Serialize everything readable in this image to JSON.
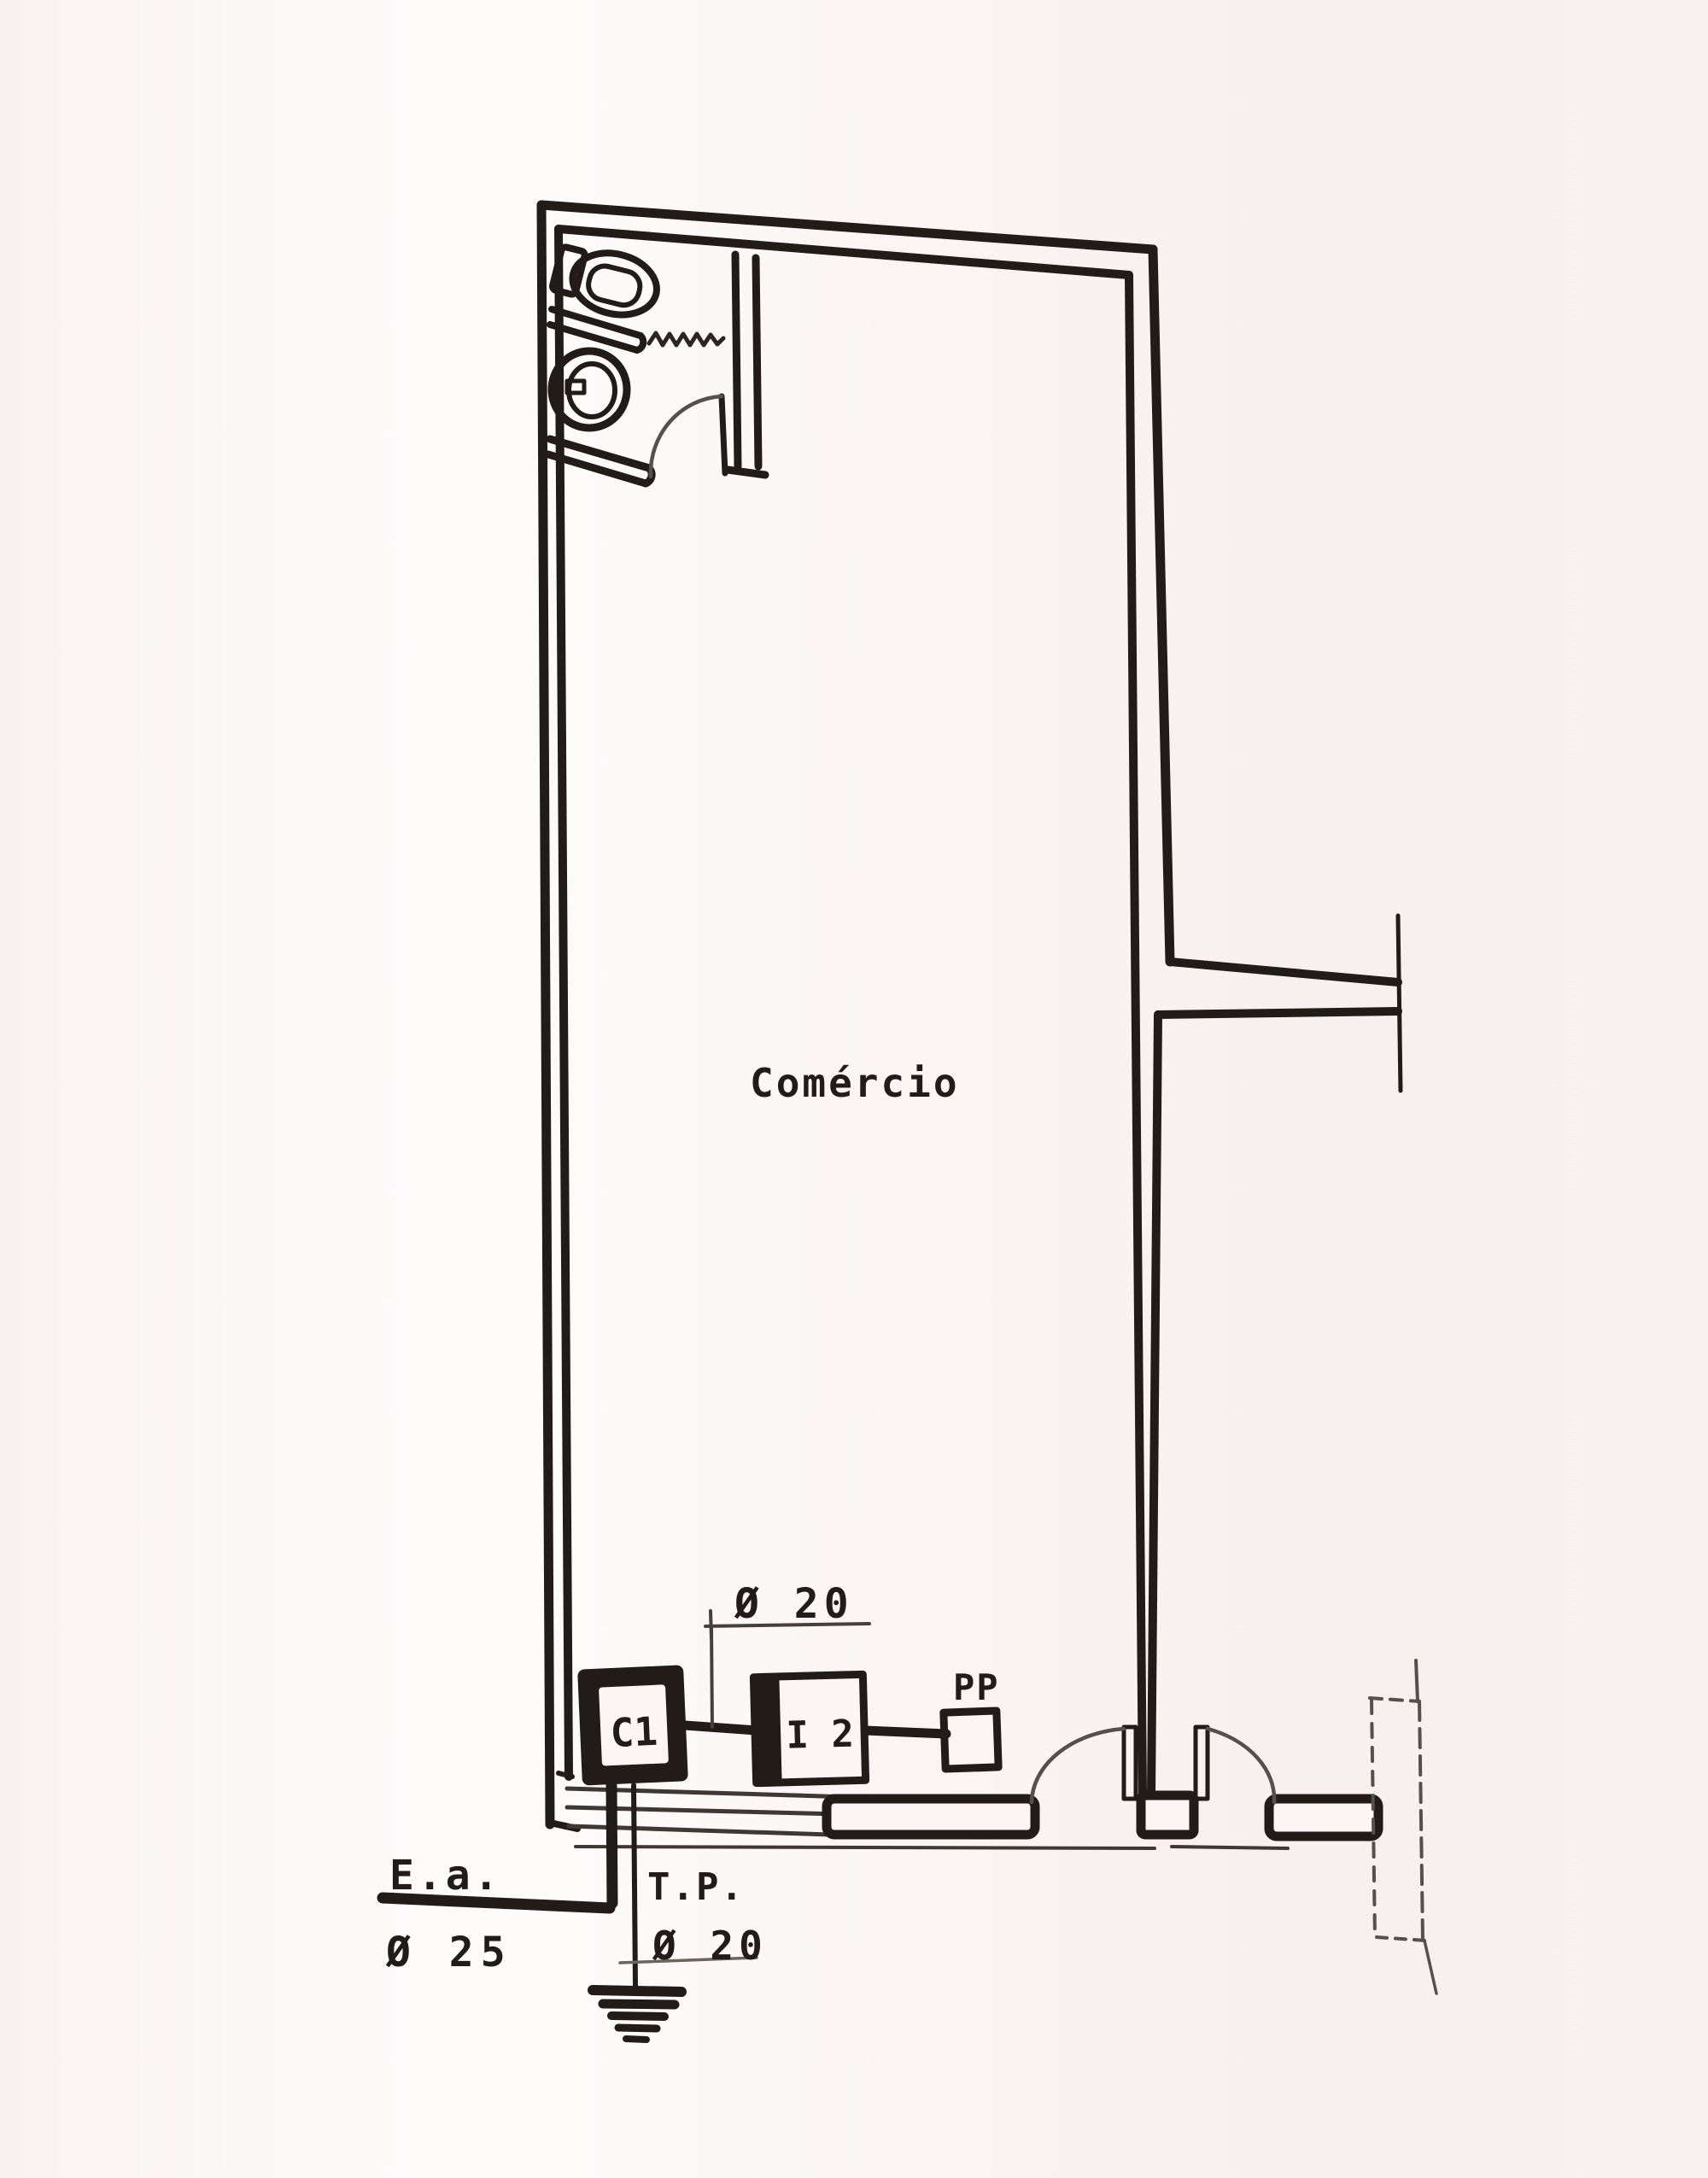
{
  "labels": {
    "room": "Comércio",
    "meter_box": "C1",
    "switch_box": "I 2",
    "pull_point": "PP",
    "service_entrance": "E.a.",
    "service_entrance_dia": "Ø 25",
    "ground_wire": "T.P.",
    "ground_wire_dia": "Ø 20",
    "conduit_dia": "Ø 20"
  },
  "colors": {
    "ink": "#221c18",
    "thin_line": "#4d4742",
    "paper": "#f9f1f0",
    "paper_light": "#fdfcfb"
  }
}
